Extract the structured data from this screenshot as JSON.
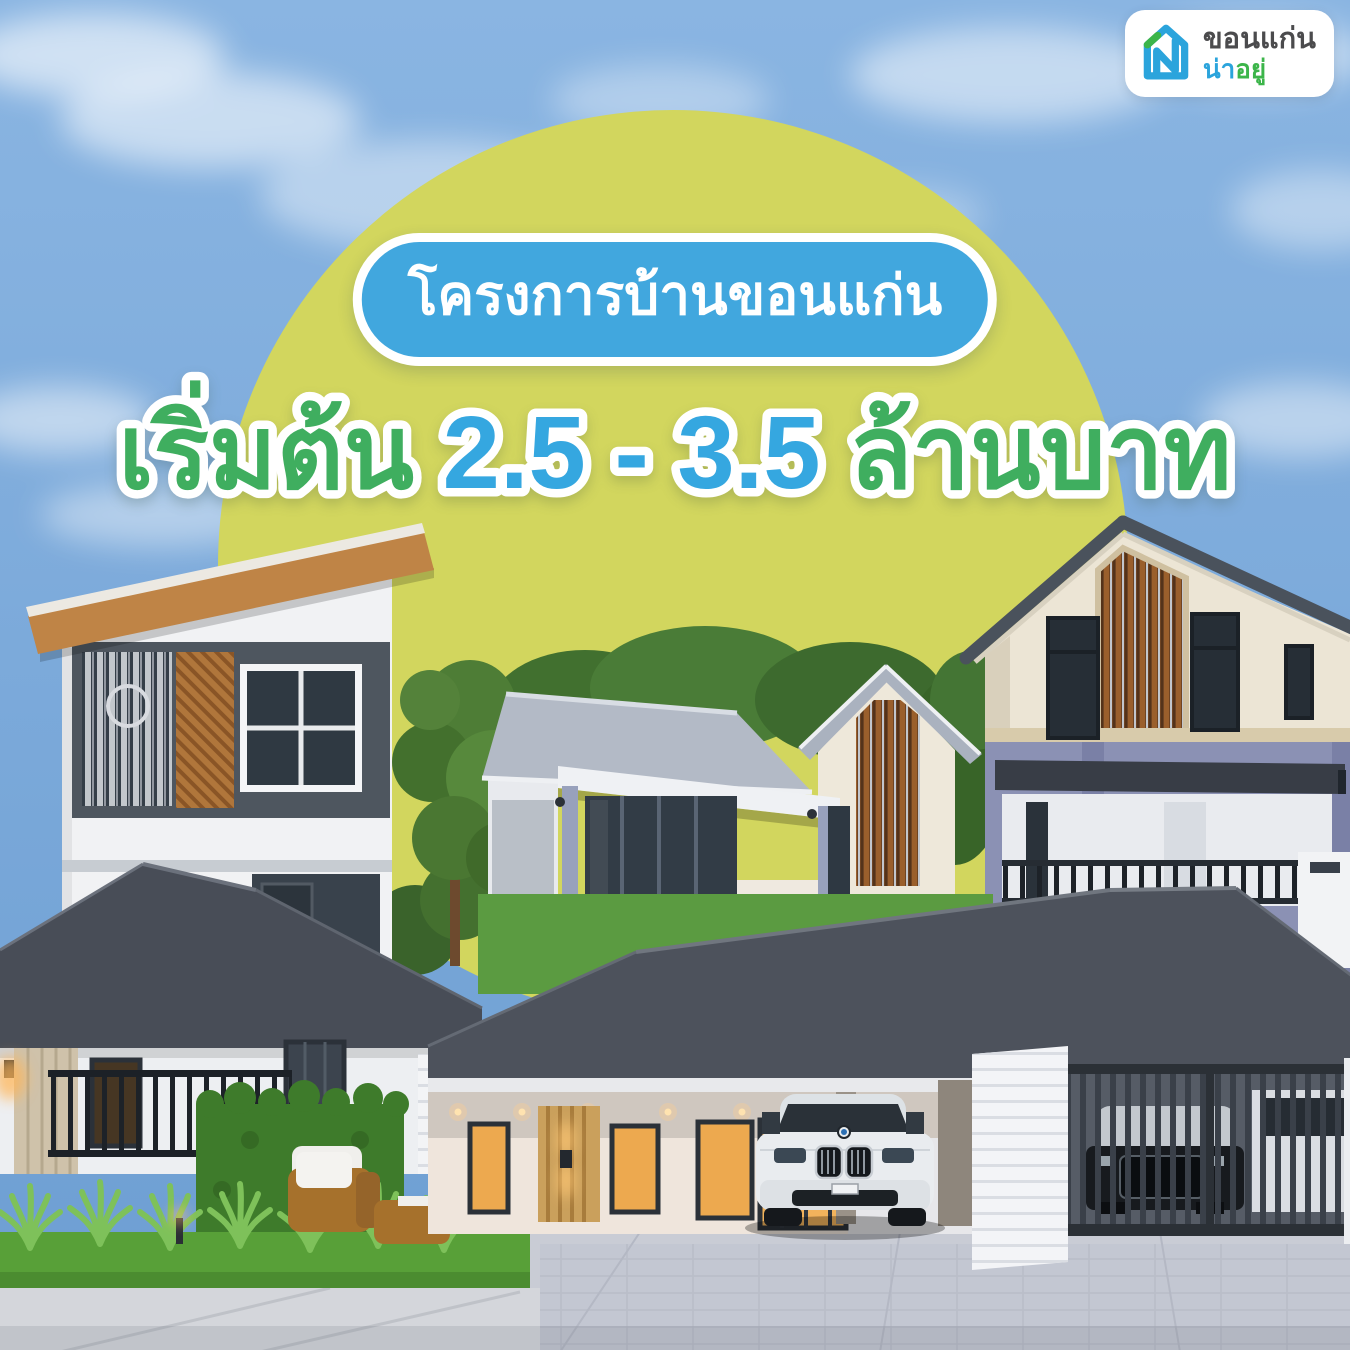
{
  "brand": {
    "name_line1": "ขอนแก่น",
    "name_line2_blue": "น่า",
    "name_line2_green": "อยู่",
    "icon": "house-n-logo-icon"
  },
  "badge": {
    "label": "โครงการบ้านขอนแก่น"
  },
  "headline": {
    "prefix": "เริ่มต้น ",
    "price_range": "2.5 - 3.5",
    "suffix": " ล้านบาท"
  },
  "colors": {
    "sky_top": "#8ab5e2",
    "sky_bottom": "#6d9ed2",
    "circle_yellow": "#d2d65e",
    "badge_blue": "#41a7de",
    "headline_green": "#3fae5f",
    "headline_blue": "#35a7e0",
    "logo_blue": "#2ba4dc",
    "logo_green": "#3cb54a"
  },
  "scene": {
    "houses": [
      "modern-two-story-house-with-slanted-roof",
      "single-story-gable-house-with-wood-slat-accent",
      "two-story-beige-gable-house",
      "single-story-hip-roof-house-with-garden-sofa",
      "single-story-house-with-carport-white-sedan-and-gate"
    ]
  }
}
